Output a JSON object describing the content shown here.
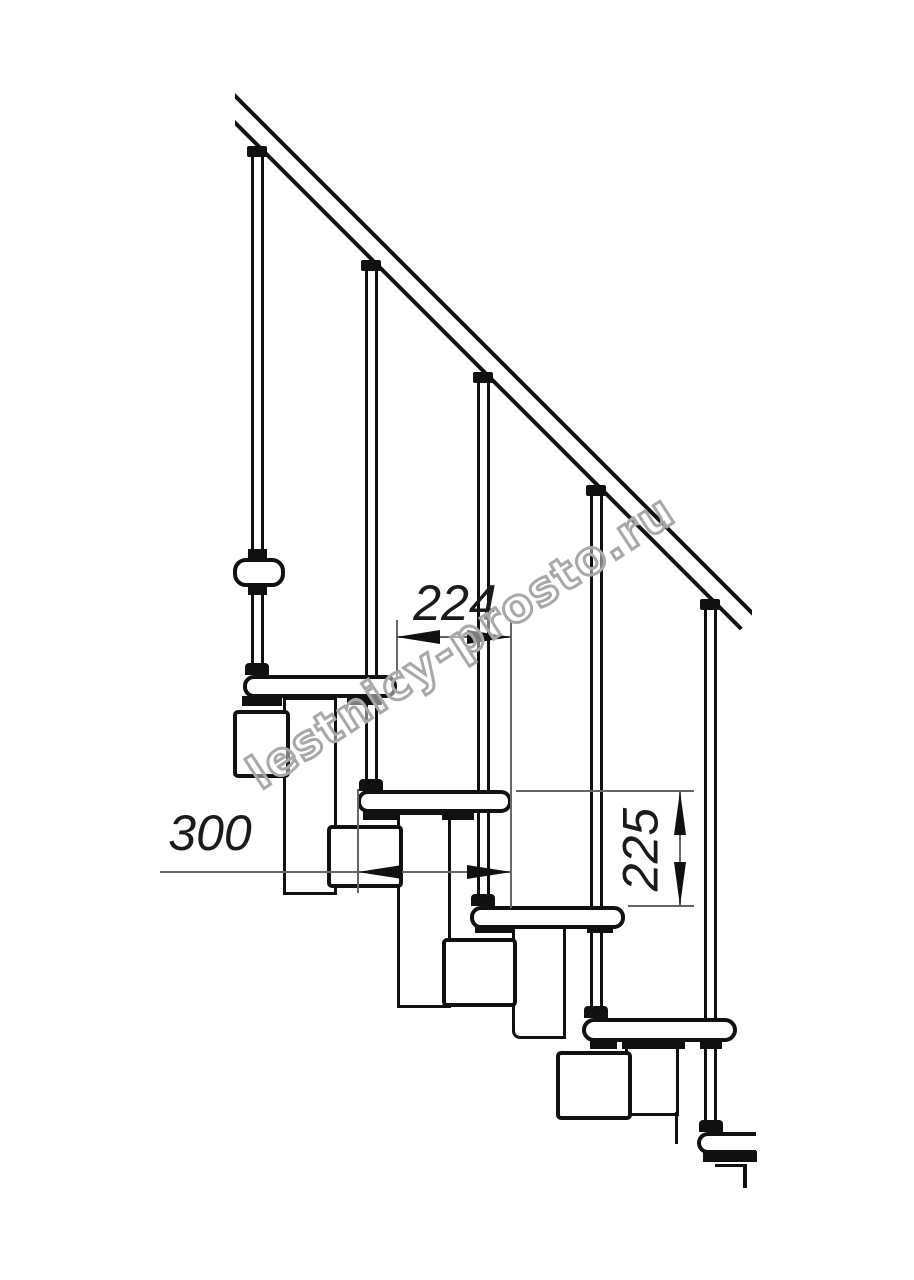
{
  "watermark": {
    "text": "lestnicy-prosto.ru",
    "stroke_color": "#a8a8a8"
  },
  "dimensions": [
    {
      "id": "step-horizontal-offset",
      "label": "224",
      "orientation": "horizontal"
    },
    {
      "id": "tread-depth",
      "label": "300",
      "orientation": "horizontal"
    },
    {
      "id": "riser-height",
      "label": "225",
      "orientation": "vertical"
    }
  ],
  "components": {
    "handrail_count": 1,
    "baluster_count": 5,
    "step_count": 6,
    "module_count": 4
  },
  "colors": {
    "background": "#ffffff",
    "ink": "#111111",
    "dimension_line": "#666666",
    "dimension_text": "#1b1b1b",
    "watermark_stroke": "#a8a8a8"
  }
}
